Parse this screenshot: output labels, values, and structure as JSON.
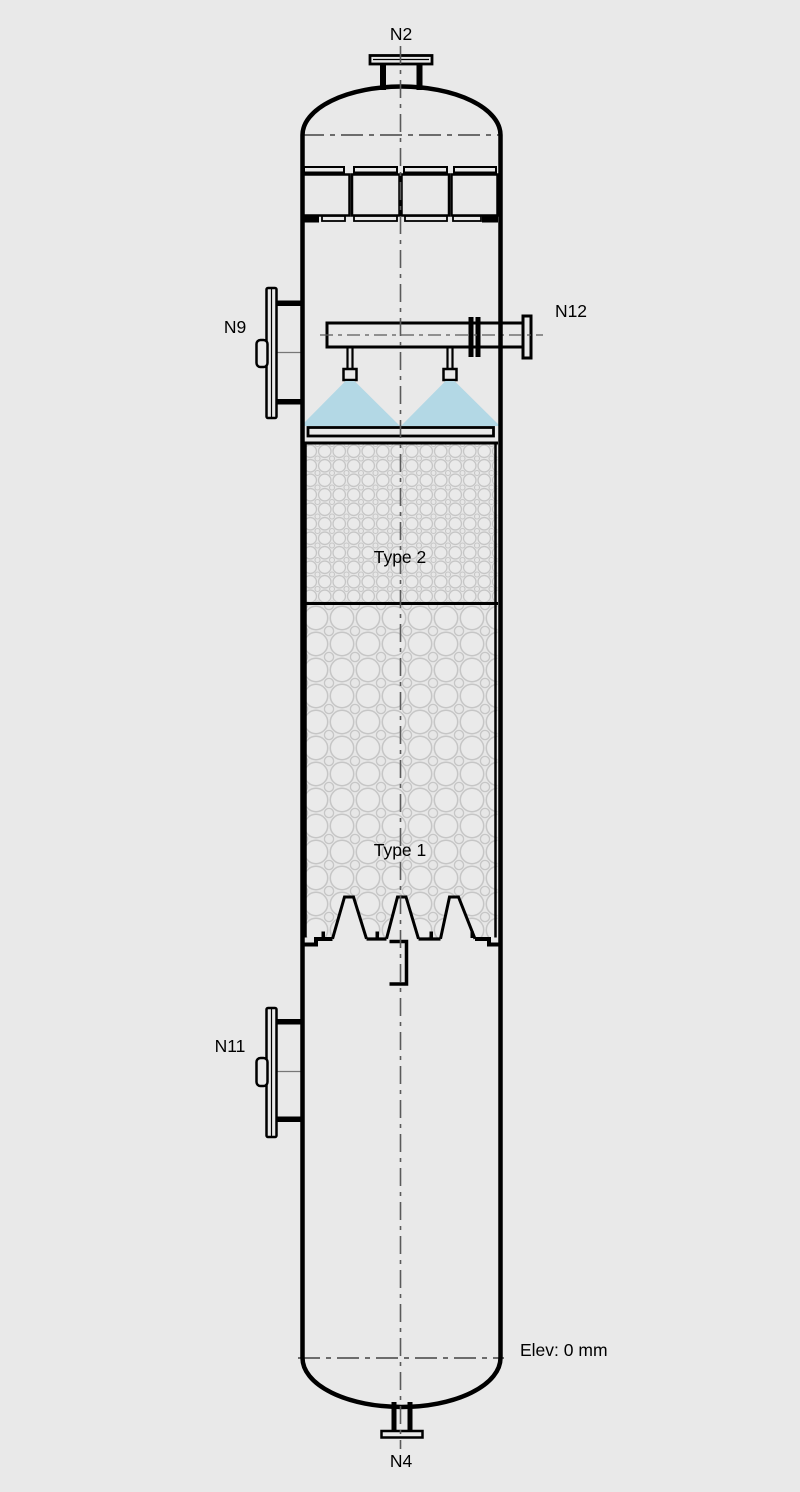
{
  "colors": {
    "background": "#e9e9e9",
    "line": "#000000",
    "centerline": "#5a5a5a",
    "spray": "#b3d8e5",
    "packing_stroke": "#c6c6c6"
  },
  "vessel": {
    "nozzles": {
      "top": "N2",
      "upper_left": "N9",
      "upper_right": "N12",
      "lower_left": "N11",
      "bottom": "N4"
    },
    "packing_beds": {
      "upper": "Type 2",
      "lower": "Type 1"
    },
    "elevation_note": "Elev: 0 mm"
  }
}
